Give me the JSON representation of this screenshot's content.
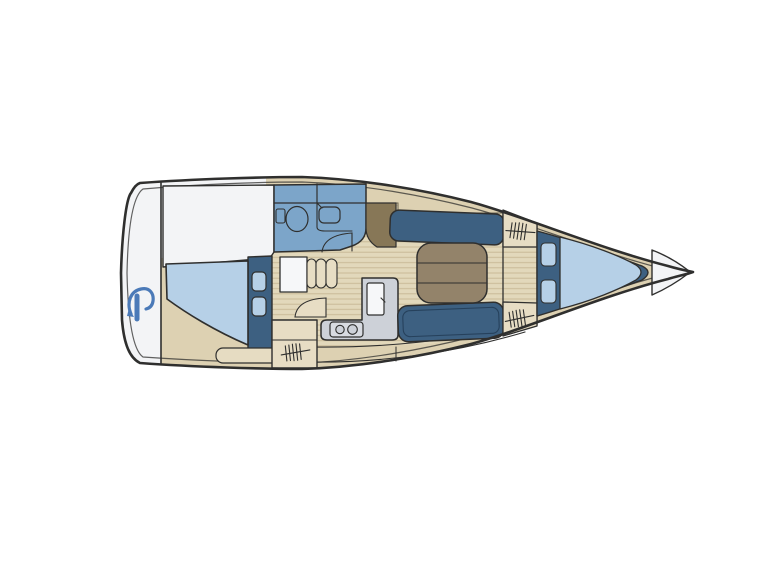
{
  "diagram": {
    "kind": "sailing-yacht interior floor plan, bow pointing right",
    "visible_text": "",
    "icons": {
      "brand_logo": "blue swoosh-around-bar mark on transom",
      "toilet": "oval bowl with tank, head compartment",
      "sink": "rounded square basin with faucet",
      "stove": "two-burner hob",
      "fridge": "rounded rectangle with handle",
      "hatch_marks": "tally-line locker/step hatching"
    }
  },
  "colors": {
    "outline": "#2f2f2e",
    "deckLine": "#6b6350",
    "hullWhite": "#f3f4f6",
    "deckTan": "#ddd1b2",
    "floorTan": "#e2d8bb",
    "plankLine": "#c9ba97",
    "boxTan": "#e7ddc4",
    "seatTan": "#e6dcc2",
    "mediumBlue": "#7ca5c9",
    "navy": "#3d6081",
    "navyEdge": "#26415c",
    "lightBlue": "#b6d0e7",
    "tableBrown": "#93836a",
    "panelBrown": "#877757",
    "galleyGray": "#cdd1d8",
    "stoveGray": "#d8dbe1",
    "whiteGoods": "#f6f7f9",
    "logoBlue": "#4b7ab8"
  }
}
